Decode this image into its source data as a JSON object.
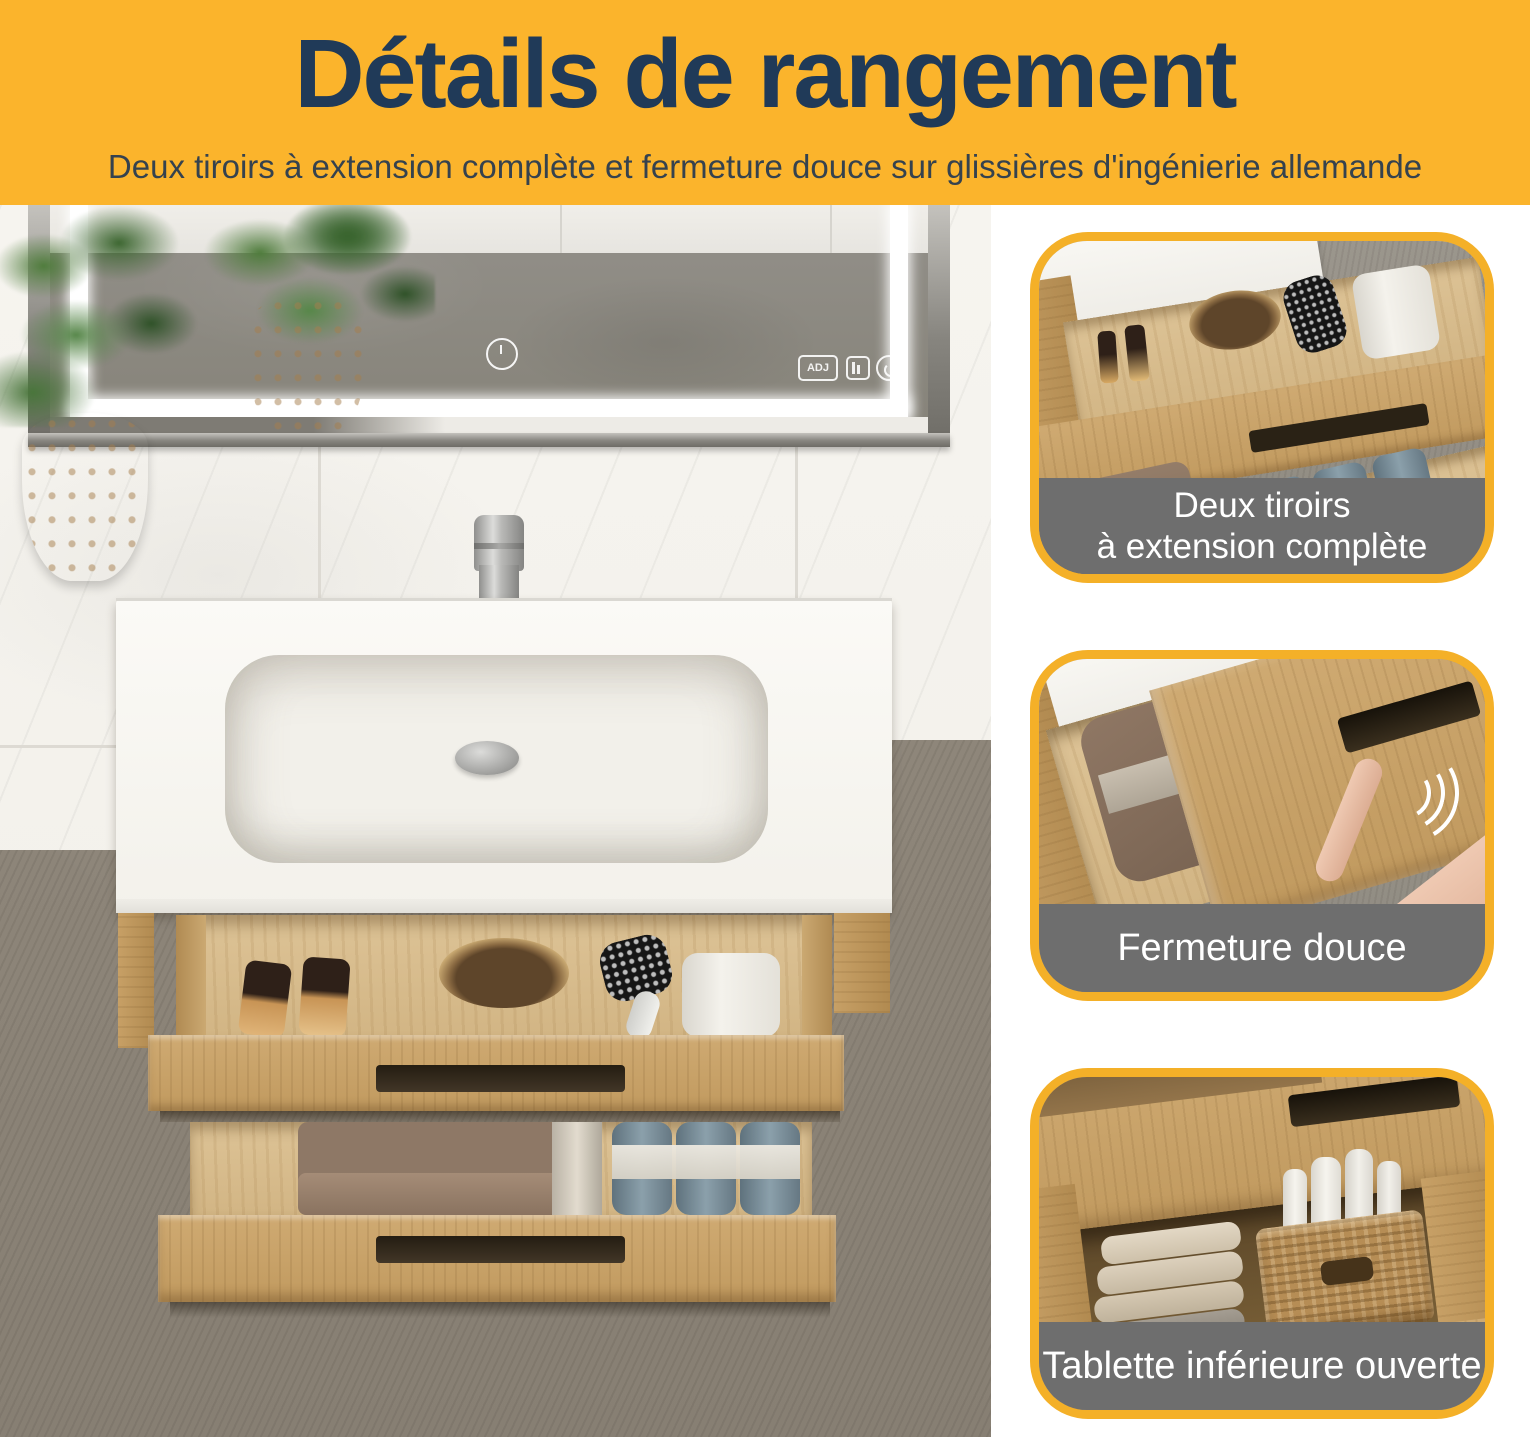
{
  "header": {
    "title": "Détails de rangement",
    "subtitle": "Deux tiroirs à extension complète et fermeture douce sur glissières d'ingénierie allemande"
  },
  "mirror_controls": {
    "adj_label": "ADJ",
    "icons": [
      "power-icon",
      "adj-icon",
      "brightness-icon",
      "defog-icon"
    ]
  },
  "callouts": [
    {
      "caption_lines": [
        "Deux tiroirs",
        "à extension complète"
      ]
    },
    {
      "caption_lines": [
        "Fermeture douce"
      ]
    },
    {
      "caption_lines": [
        "Tablette inférieure ouverte"
      ]
    }
  ],
  "colors": {
    "band_yellow": "#FBB42C",
    "card_border_yellow": "#F4B028",
    "title_navy": "#203A58",
    "subtitle_slate": "#35424E",
    "caption_bar_gray": "#6E6E6E",
    "caption_text": "#FFFFFF",
    "wood_oak": "#C7A066",
    "floor_gray": "#8D8579"
  }
}
